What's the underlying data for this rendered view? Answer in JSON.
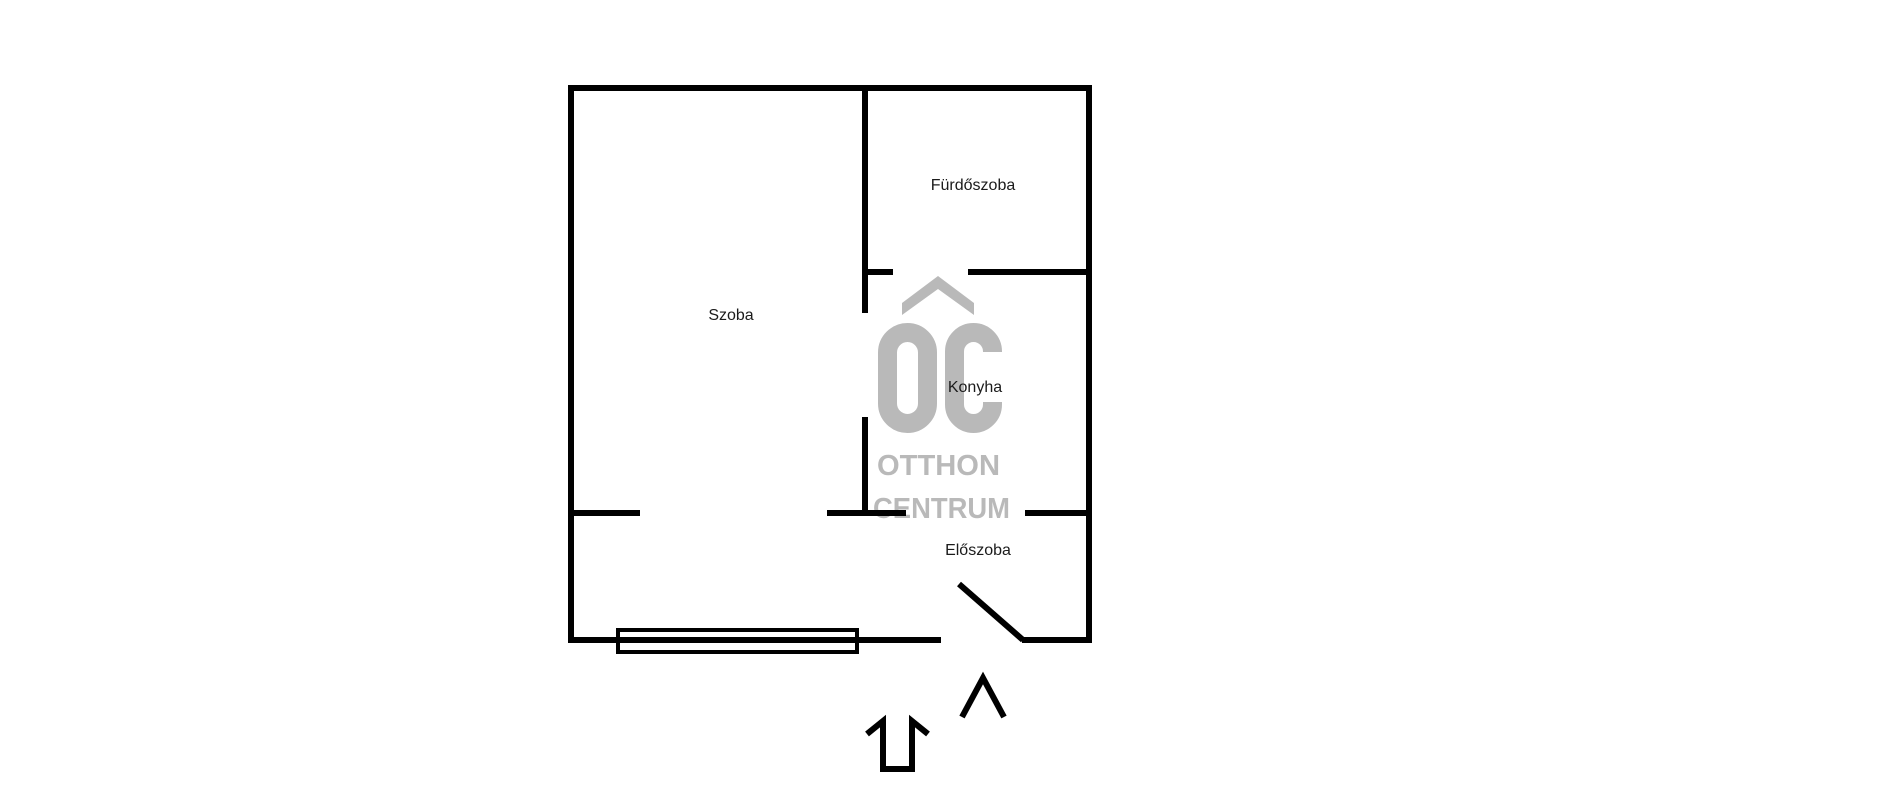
{
  "page": {
    "background": "#ffffff"
  },
  "floorplan": {
    "colors": {
      "wall": "#000000",
      "label": "#1b1b1b",
      "watermark": "#b9b9b9"
    },
    "rooms": {
      "szoba": "Szoba",
      "furdoszoba": "Fürdőszoba",
      "konyha": "Konyha",
      "eloszoba": "Előszoba"
    },
    "watermark": {
      "logo": "OC",
      "line1": "OTTHON",
      "line2": "CENTRUM"
    }
  }
}
